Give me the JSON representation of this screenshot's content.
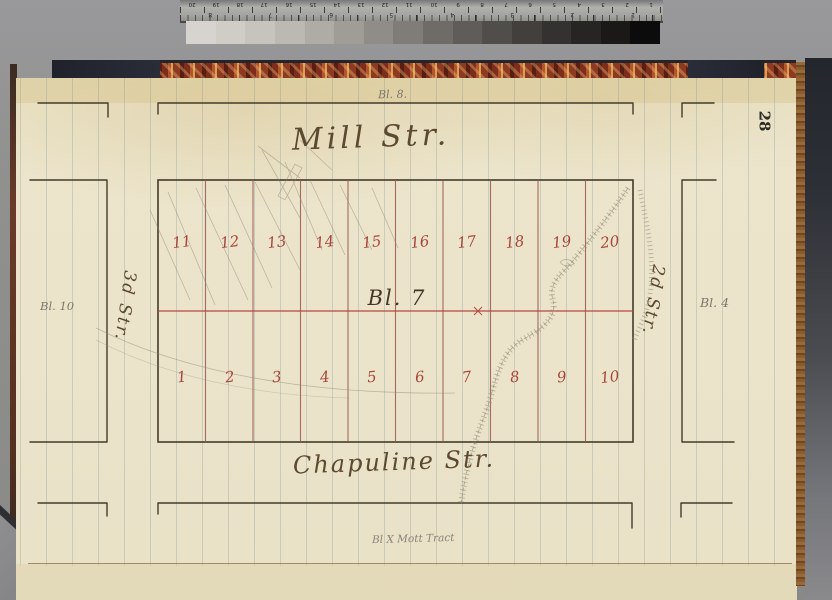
{
  "photo_targets": {
    "ruler": {
      "cm_numbers": [
        "20",
        "19",
        "18",
        "17",
        "16",
        "15",
        "14",
        "13",
        "12",
        "11",
        "10",
        "9",
        "8",
        "7",
        "6",
        "5",
        "4",
        "3",
        "2",
        "1"
      ],
      "inch_numbers": [
        "8",
        "7",
        "6",
        "5",
        "4",
        "3",
        "2",
        "1"
      ]
    },
    "grayscale_wedge": {
      "steps": [
        {
          "color": "#d7d4cf"
        },
        {
          "color": "#d0cdc7"
        },
        {
          "color": "#c7c3bd"
        },
        {
          "color": "#bcb8b2"
        },
        {
          "color": "#afaba5"
        },
        {
          "color": "#a09c96"
        },
        {
          "color": "#908c87"
        },
        {
          "color": "#807c77"
        },
        {
          "color": "#6f6c68"
        },
        {
          "color": "#5f5c59"
        },
        {
          "color": "#504e4b"
        },
        {
          "color": "#423f3d"
        },
        {
          "color": "#343230"
        },
        {
          "color": "#272523"
        },
        {
          "color": "#1a1918"
        },
        {
          "color": "#0d0c0c"
        }
      ]
    }
  },
  "page": {
    "page_number": "28",
    "annotations": {
      "block_above": "Bl. 8.",
      "block_left": "Bl. 10",
      "block_right": "Bl. 4",
      "tract_note": "Bl X Mott Tract"
    },
    "map": {
      "street_north": "Mill Str.",
      "street_south": "Chapuline Str.",
      "street_west": "3d Str.",
      "street_east": "2d Str.",
      "block_label": "Bl. 7",
      "lots_upper": [
        "11",
        "12",
        "13",
        "14",
        "15",
        "16",
        "17",
        "18",
        "19",
        "20"
      ],
      "lots_lower": [
        "1",
        "2",
        "3",
        "4",
        "5",
        "6",
        "7",
        "8",
        "9",
        "10"
      ],
      "colors": {
        "ink": "#5b4930",
        "lot_red": "#a6463c",
        "line_red": "#b2493d",
        "pencil": "#7e786c"
      }
    }
  }
}
